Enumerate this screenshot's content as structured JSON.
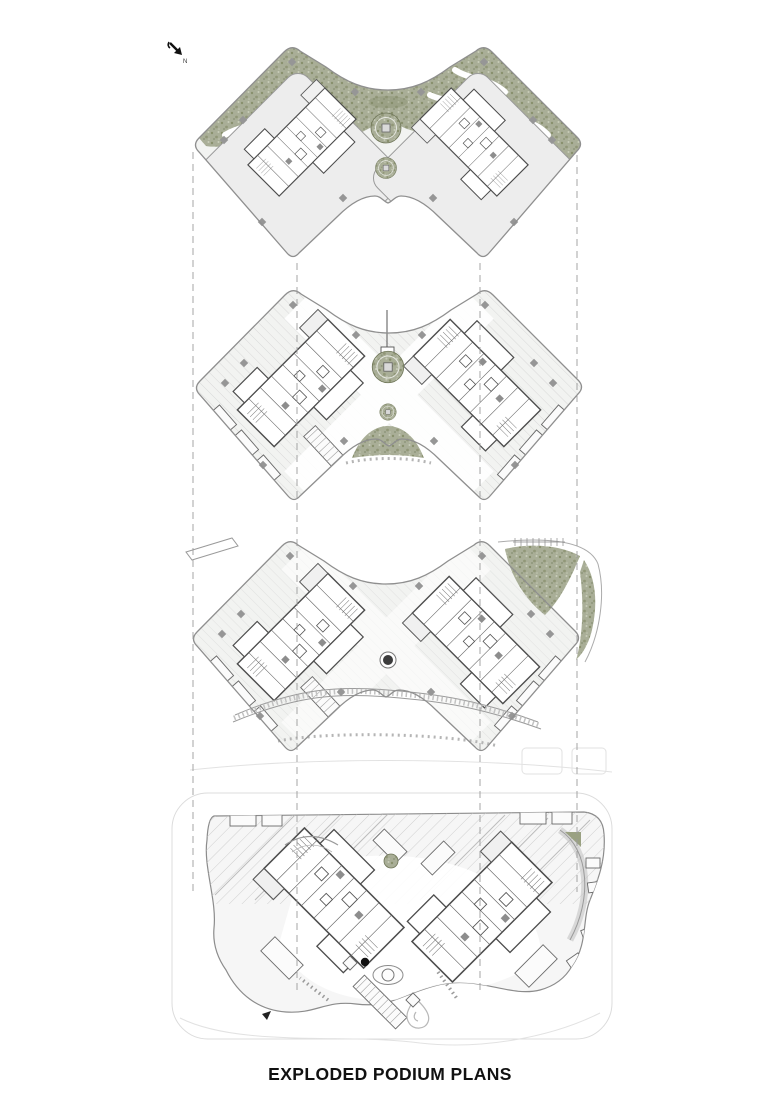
{
  "page": {
    "title": "EXPLODED PODIUM PLANS"
  },
  "north_indicator": {
    "label": "N",
    "icon": "north-arrow-icon",
    "direction": "south-east"
  },
  "plans": [
    {
      "name": "roof-garden-plan"
    },
    {
      "name": "upper-podium-plan"
    },
    {
      "name": "mid-podium-plan"
    },
    {
      "name": "ground-floor-plan"
    }
  ],
  "colors": {
    "paper": "#ffffff",
    "outline": "#8f8f8f",
    "wall": "#4d4d4d",
    "floor": "#f2f3f1",
    "floor_alt": "#ededed",
    "vegetation": "#a9ae97",
    "vegetation_dark": "#7d855f",
    "vegetation_light": "#c8ccb8",
    "hatch": "#d6d6d6",
    "guide": "#9b9b9b",
    "ink": "#111111"
  },
  "guides": {
    "dash": "7 5",
    "lines": [
      {
        "x": 193,
        "y1": 152,
        "y2": 892
      },
      {
        "x": 297,
        "y1": 263,
        "y2": 992
      },
      {
        "x": 480,
        "y1": 263,
        "y2": 992
      },
      {
        "x": 577,
        "y1": 155,
        "y2": 892
      }
    ]
  }
}
